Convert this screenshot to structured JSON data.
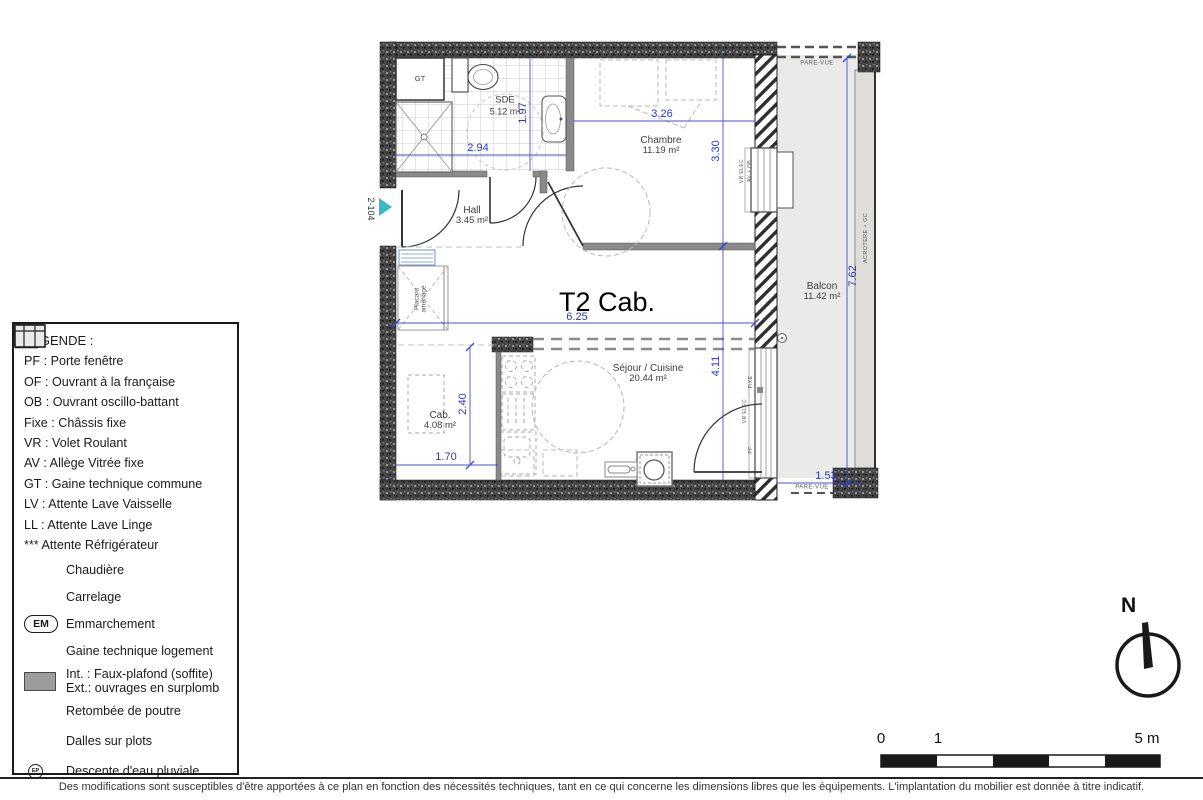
{
  "plan": {
    "title": "T2 Cab.",
    "unit_number": "2-104",
    "rooms": {
      "sde": {
        "name": "SDE",
        "area": "5.12 m²"
      },
      "chambre": {
        "name": "Chambre",
        "area": "11.19 m²"
      },
      "hall": {
        "name": "Hall",
        "area": "3.45 m²"
      },
      "cab": {
        "name": "Cab.",
        "area": "4.08 m²"
      },
      "sejour": {
        "name": "Séjour / Cuisine",
        "area": "20.44 m²"
      },
      "balcon": {
        "name": "Balcon",
        "area": "11.42 m²"
      }
    },
    "labels": {
      "gt": "GT",
      "placard": "Placard\naménagé",
      "pare_vue_top": "PARE-VUE",
      "pare_vue_bottom": "PARE-VUE",
      "acrotere": "ACROTÈRE + GC",
      "win_chambre_1": "VR ELEC",
      "win_chambre_2": "AV + OB",
      "win_sejour_fixe": "FIXE",
      "win_sejour_vr": "VR ELEC",
      "win_sejour_pf": "PF"
    },
    "dims": {
      "sde_w": "2.94",
      "sde_h": "1.97",
      "chambre_w": "3.26",
      "chambre_h": "3.30",
      "width": "6.25",
      "sejour_h": "4.11",
      "cab_h": "2.40",
      "cab_w": "1.70",
      "balcon_h": "7.62",
      "balcon_w": "1.53"
    }
  },
  "legend": {
    "title": "LEGENDE :",
    "abbreviations": [
      "PF : Porte fenêtre",
      "OF : Ouvrant à la française",
      "OB : Ouvrant oscillo-battant",
      "Fixe : Châssis fixe",
      "VR : Volet Roulant",
      "AV : Allège Vitrée fixe",
      "GT : Gaine technique commune",
      "LV : Attente Lave Vaisselle",
      "LL : Attente Lave Linge",
      "*** Attente Réfrigérateur"
    ],
    "symbols": [
      {
        "icon": "boiler-icon",
        "label": "Chaudière"
      },
      {
        "icon": "tiles-icon",
        "label": "Carrelage"
      },
      {
        "icon": "em-icon",
        "badge": "EM",
        "label": "Emmarchement"
      },
      {
        "icon": "duct-arrow-icon",
        "label": "Gaine technique logement"
      },
      {
        "icon": "soffit-icon",
        "label": "Int. : Faux-plafond (soffite)",
        "label2": "Ext.: ouvrages en surplomb"
      },
      {
        "icon": "beam-icon",
        "label": "Retombée de poutre"
      },
      {
        "icon": "slabs-icon",
        "label": "Dalles sur plots"
      },
      {
        "icon": "ep-icon",
        "badge": "EP",
        "label": "Descente d'eau pluviale"
      }
    ]
  },
  "compass": {
    "north": "N"
  },
  "scalebar": {
    "tick0": "0",
    "tick1": "1",
    "tick5": "5 m"
  },
  "footer": {
    "disclaimer": "Des modifications sont susceptibles d'être apportées à ce plan en fonction des nécessités techniques, tant en ce qui concerne les dimensions libres que les équipements. L'implantation du mobilier est donnée à titre indicatif."
  },
  "colors": {
    "dimension": "#2936c8",
    "entrance_marker": "#3db6c6",
    "wall_dark": "#414141",
    "balcony_deck": "#eaeae8"
  }
}
